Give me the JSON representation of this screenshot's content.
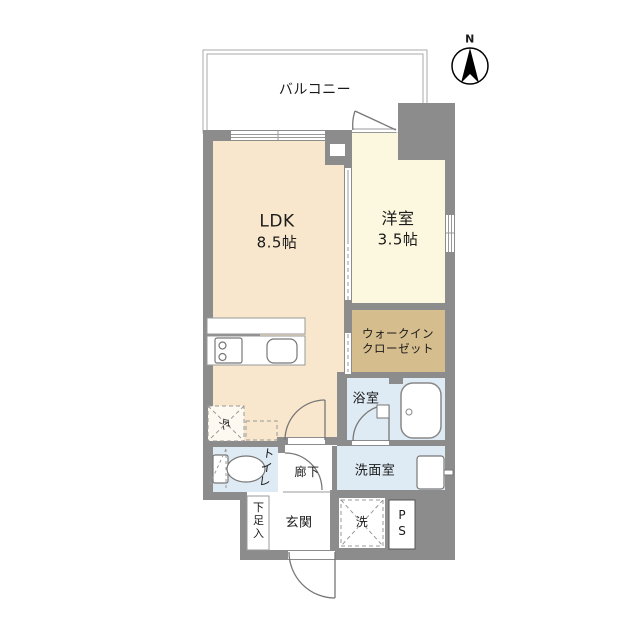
{
  "title": "apartment-floorplan",
  "compass": {
    "north_label": "N"
  },
  "balcony": {
    "label": "バルコニー"
  },
  "rooms": {
    "ldk": {
      "name": "LDK",
      "size": "8.5帖"
    },
    "western_room": {
      "name": "洋室",
      "size": "3.5帖"
    },
    "walk_in_closet": {
      "line1": "ウォークイン",
      "line2": "クローゼット"
    },
    "bathroom": {
      "label": "浴室"
    },
    "washroom": {
      "label": "洗面室"
    },
    "toilet": {
      "label": "トイレ"
    },
    "hallway": {
      "label": "廊下"
    },
    "entrance": {
      "label": "玄関"
    },
    "shoe_storage": {
      "label": "下足入"
    },
    "pipe_space": {
      "label": "PS"
    }
  },
  "fixtures": {
    "washing_machine": {
      "label": "洗"
    },
    "refrigerator": {
      "label": "冷"
    }
  },
  "colors": {
    "wall": "#8C8C8C",
    "ldk_floor": "#F8E7CC",
    "western_room_floor": "#FCF7DF",
    "closet_floor": "#D5BD8E",
    "wet_area_floor": "#DEEBF4",
    "outline": "#A9A9A9",
    "text": "#1A1A1A"
  }
}
